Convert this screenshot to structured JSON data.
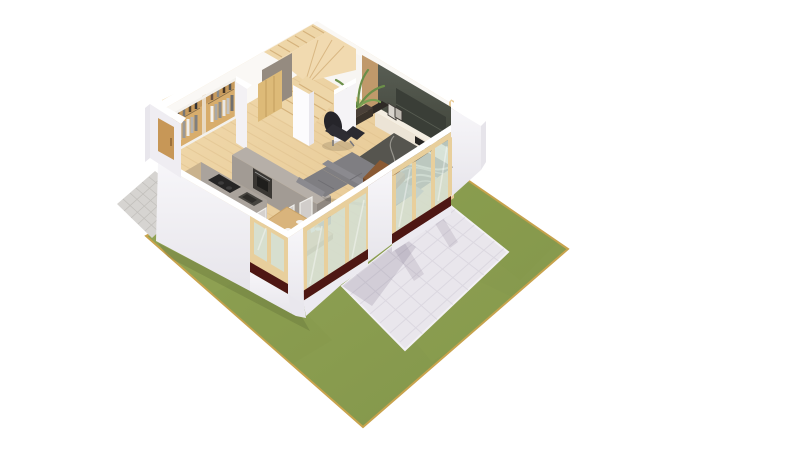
{
  "meta": {
    "title": "3D isometric cutaway floor plan render",
    "description": "Bird's-eye isometric 3D rendering of a small house ground floor with open-plan living room, kitchen, dining corner and winder staircase, surrounded by a lawn, a tiled terrace and a paver walkway on a white background.",
    "style": "architectural visualization",
    "background": "#ffffff"
  },
  "scene": {
    "exterior": [
      {
        "name": "lawn",
        "color": "#8d9e4f"
      },
      {
        "name": "terrace-patio",
        "color": "#e9e6ec"
      },
      {
        "name": "paver-walkway",
        "color": "#d6d4d1"
      }
    ],
    "rooms": [
      {
        "name": "living-room",
        "items": [
          "corner-sofa",
          "area-rug",
          "coffee-table",
          "lounge-chair",
          "tv-accent-wall",
          "media-console",
          "potted-plant",
          "picture-frames"
        ]
      },
      {
        "name": "kitchen",
        "items": [
          "counter-with-cooktop",
          "sink",
          "built-in-oven",
          "peninsula-cabinet"
        ]
      },
      {
        "name": "dining-corner",
        "items": [
          "wooden-table",
          "ghost-chairs",
          "flower-vase",
          "corner-windows"
        ]
      },
      {
        "name": "hall",
        "items": [
          "winder-staircase",
          "wardrobe-with-clothes",
          "under-stair-closet",
          "entry-door"
        ]
      }
    ],
    "architecture": [
      "white-cut-walls",
      "sliding-glass-doors",
      "wood-window-frames",
      "dark-thresholds",
      "light-wood-floor",
      "brick-wall-core"
    ]
  },
  "palette": {
    "grass": "#8d9e4f",
    "grassDark": "#7e9143",
    "lawnEdge": "#c8a34d",
    "patio": "#e9e6ec",
    "patioLine": "#d7d3dd",
    "patioShadow": "rgba(105,95,120,0.18)",
    "paver": "#d6d4d1",
    "paverLine": "#c0beba",
    "wallTop": "#ffffff",
    "wallFace": "#f1eff3",
    "wallInner": "#faf8f5",
    "floorWood": "#ecd2a2",
    "plankLine": "#ddbd8a",
    "stairWood": "#eed6a8",
    "treadLine": "#d5b27c",
    "understairPanel": "#958b80",
    "cabinetTan": "#ddba78",
    "closetWood": "#d8ad6c",
    "tvPanel": "#4b4f47",
    "tvScreen": "#3a3e37",
    "woodStrip": "#c0996b",
    "brick": "#96655a",
    "console": "#ece4d6",
    "consoleTop": "#f4eee2",
    "sofa": "#7f7e82",
    "sofaAccent": "#8b8a8f",
    "rug": "#56554f",
    "rugPattern": "#ccc9c1",
    "coffeeTable": "#8a5a33",
    "loungeChair": "#26252a",
    "diningTable": "#d9b47c",
    "counterTop": "#c9b28d",
    "counterFace": "#a29b94",
    "peninsulaTop": "#b6afa8",
    "oven": "#3a3733",
    "cooktop": "#262525",
    "sink": "#46443f",
    "glass": "#d3e2d8",
    "frame": "#e8cf9c",
    "threshold": "#4e1713",
    "plant": "#6b8f49",
    "planter": "#332c25",
    "flower": "#c87292",
    "door": "#c79757",
    "groundShadow": "rgba(70,80,40,0.2)"
  }
}
